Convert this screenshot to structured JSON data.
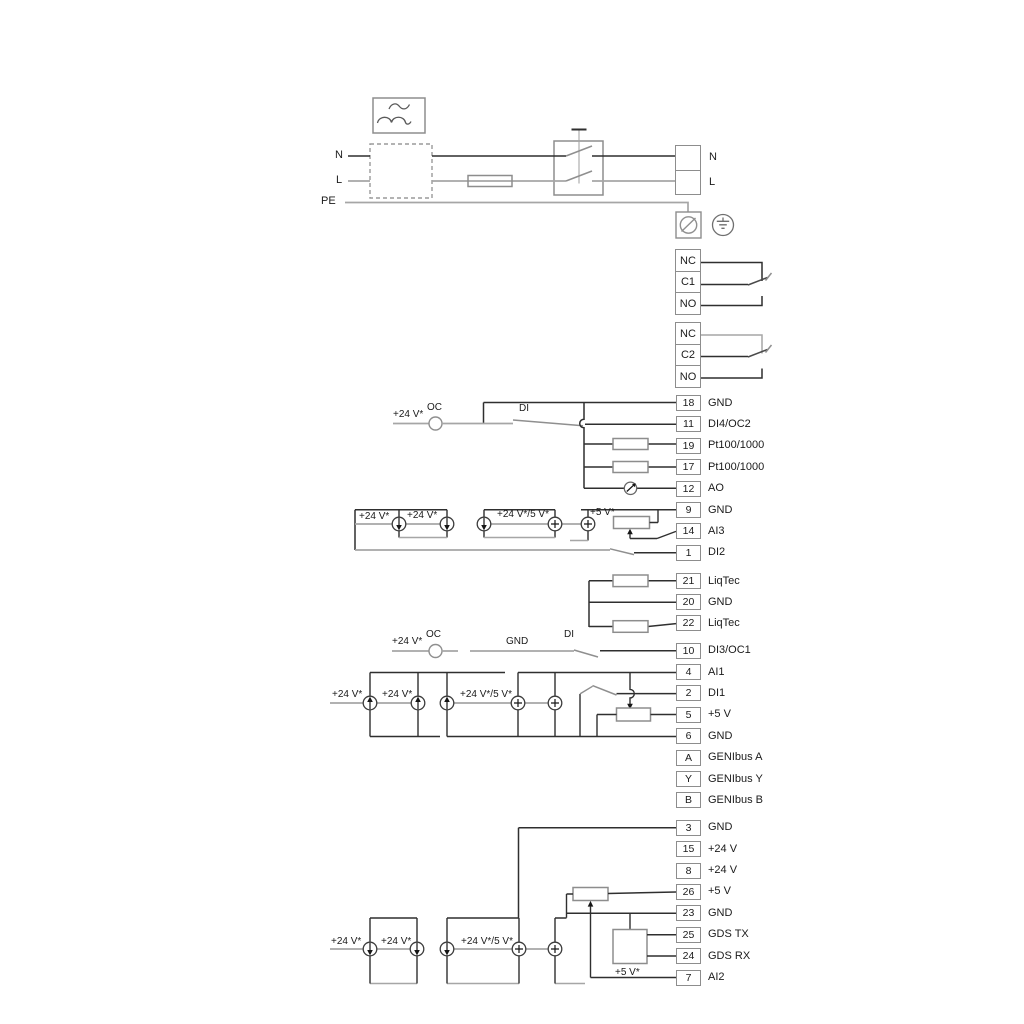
{
  "page": {
    "background": "#ffffff"
  },
  "colors": {
    "wire_dark": "#2f2f2f",
    "wire_gray": "#a6a6a6",
    "box_border": "#8d8d8d",
    "text": "#1b1b1b"
  },
  "labels": {
    "v24": "+24 V*",
    "v24_5": "+24 V*/5 V*",
    "v5": "+5 V*",
    "oc": "OC",
    "di": "DI",
    "gnd": "GND"
  },
  "mains": {
    "left": {
      "n": "N",
      "l": "L",
      "pe": "PE"
    },
    "right": {
      "n": "N",
      "l": "L"
    }
  },
  "relays": [
    {
      "cells": [
        "NC",
        "C1",
        "NO"
      ]
    },
    {
      "cells": [
        "NC",
        "C2",
        "NO"
      ]
    }
  ],
  "groups": {
    "g1": [
      {
        "id": "18",
        "label": "GND"
      },
      {
        "id": "11",
        "label": "DI4/OC2"
      },
      {
        "id": "19",
        "label": "Pt100/1000"
      },
      {
        "id": "17",
        "label": "Pt100/1000"
      },
      {
        "id": "12",
        "label": "AO"
      },
      {
        "id": "9",
        "label": "GND"
      },
      {
        "id": "14",
        "label": "AI3"
      },
      {
        "id": "1",
        "label": "DI2"
      }
    ],
    "g2": [
      {
        "id": "21",
        "label": "LiqTec"
      },
      {
        "id": "20",
        "label": "GND"
      },
      {
        "id": "22",
        "label": "LiqTec"
      }
    ],
    "g3": [
      {
        "id": "10",
        "label": "DI3/OC1"
      }
    ],
    "g4": [
      {
        "id": "4",
        "label": "AI1"
      },
      {
        "id": "2",
        "label": "DI1"
      },
      {
        "id": "5",
        "label": "+5 V"
      },
      {
        "id": "6",
        "label": "GND"
      },
      {
        "id": "A",
        "label": "GENIbus A"
      },
      {
        "id": "Y",
        "label": "GENIbus Y"
      },
      {
        "id": "B",
        "label": "GENIbus B"
      }
    ],
    "g5": [
      {
        "id": "3",
        "label": "GND"
      },
      {
        "id": "15",
        "label": "+24 V"
      },
      {
        "id": "8",
        "label": "+24 V"
      },
      {
        "id": "26",
        "label": "+5 V"
      },
      {
        "id": "23",
        "label": "GND"
      },
      {
        "id": "25",
        "label": "GDS TX"
      },
      {
        "id": "24",
        "label": "GDS RX"
      },
      {
        "id": "7",
        "label": "AI2"
      }
    ]
  },
  "icons": {
    "wave_box": "sine-filter-icon",
    "screw": "screw-terminal-icon",
    "earth": "protective-earth-icon"
  }
}
